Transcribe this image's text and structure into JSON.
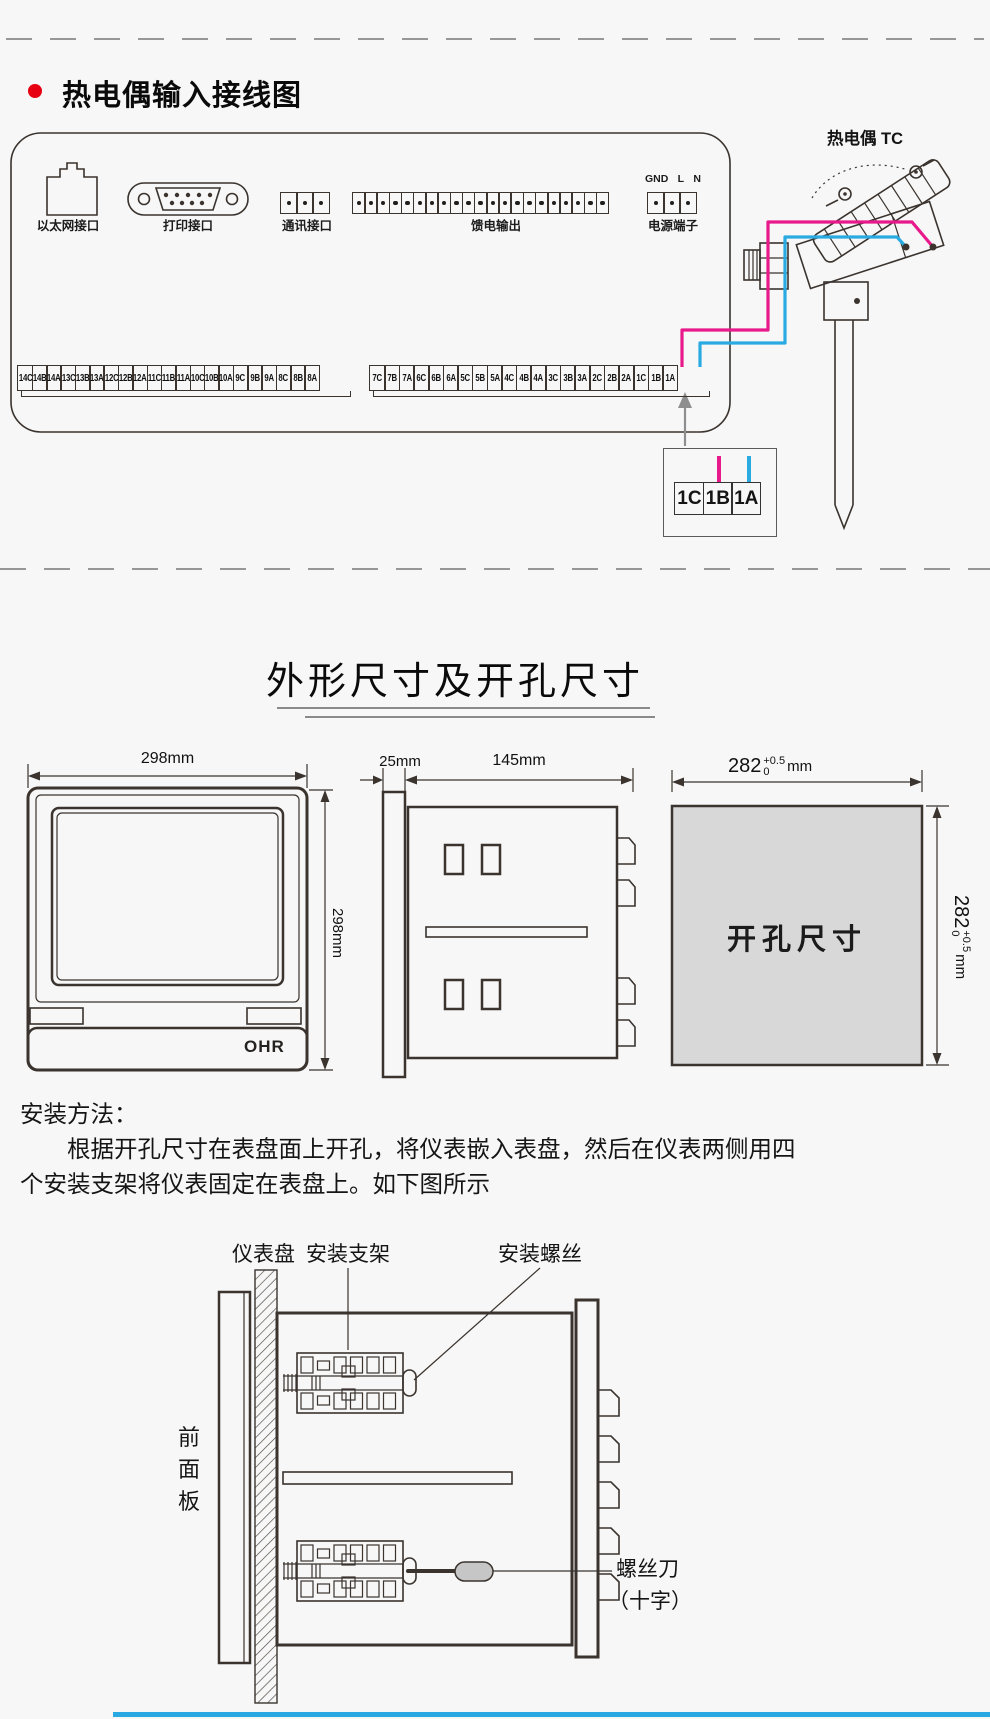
{
  "colors": {
    "line": "#3a332e",
    "wire_pink": "#e8198b",
    "wire_blue": "#29abe2",
    "bullet_red": "#e60012",
    "cutout_fill": "#d8d8d8",
    "arrow_gray": "#8e8e8e",
    "rule_blue": "#29a8e2",
    "handle_gray": "#c6c6c6"
  },
  "wiring": {
    "title": "热电偶输入接线图",
    "tc_label": "热电偶 TC",
    "ports": {
      "ethernet": {
        "label": "以太网接口"
      },
      "printer": {
        "label": "打印接口"
      },
      "comm": {
        "label": "通讯接口",
        "terminals": 3
      },
      "feed": {
        "label": "馈电输出",
        "terminals": 21
      },
      "power": {
        "label": "电源端子",
        "terminals": 3,
        "pins": [
          "GND",
          "L",
          "N"
        ]
      }
    },
    "strip_left": [
      "14C",
      "14B",
      "14A",
      "13C",
      "13B",
      "13A",
      "12C",
      "12B",
      "12A",
      "11C",
      "11B",
      "11A",
      "10C",
      "10B",
      "10A",
      "9C",
      "9B",
      "9A",
      "8C",
      "8B",
      "8A"
    ],
    "strip_right": [
      "7C",
      "7B",
      "7A",
      "6C",
      "6B",
      "6A",
      "5C",
      "5B",
      "5A",
      "4C",
      "4B",
      "4A",
      "3C",
      "3B",
      "3A",
      "2C",
      "2B",
      "2A",
      "1C",
      "1B",
      "1A"
    ],
    "detail_cells": [
      "1C",
      "1B",
      "1A"
    ]
  },
  "dimensions": {
    "title": "外形尺寸及开孔尺寸",
    "front": {
      "width": "298mm",
      "height": "298mm",
      "logo": "OHR"
    },
    "side": {
      "depth_front": "25mm",
      "depth_body": "145mm"
    },
    "cutout": {
      "label": "开孔尺寸",
      "value": "282",
      "tol_plus": "+0.5",
      "tol_minus": "0",
      "unit": "mm"
    }
  },
  "install": {
    "heading": "安装方法：",
    "line1": "根据开孔尺寸在表盘面上开孔，将仪表嵌入表盘，然后在仪表两侧用四",
    "line2": "个安装支架将仪表固定在表盘上。如下图所示",
    "labels": {
      "panel": "仪表盘",
      "bracket": "安装支架",
      "screw": "安装螺丝",
      "front_panel": [
        "前",
        "面",
        "板"
      ],
      "screwdriver_line1": "螺丝刀",
      "screwdriver_line2": "（十字）"
    }
  }
}
